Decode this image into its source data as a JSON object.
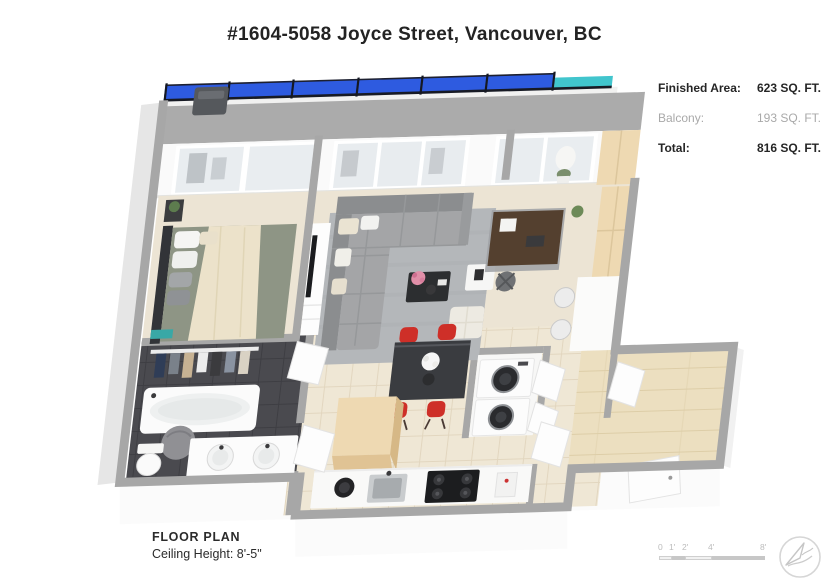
{
  "page": {
    "title": "#1604-5058 Joyce Street, Vancouver, BC"
  },
  "area_summary": {
    "finished": {
      "label": "Finished Area:",
      "value": "623 SQ. FT."
    },
    "balcony": {
      "label": "Balcony:",
      "value": "193 SQ. FT."
    },
    "total": {
      "label": "Total:",
      "value": "816 SQ. FT."
    }
  },
  "footer": {
    "plan_label": "FLOOR PLAN",
    "ceiling_height_label": "Ceiling Height: 8'-5\""
  },
  "scale_bar": {
    "tick_0": "0",
    "tick_1": "1'",
    "tick_2": "2'",
    "tick_4": "4'",
    "tick_8": "8'"
  },
  "colors": {
    "balcony_glass": "#2e5be0",
    "glass_teal": "#41c5cd",
    "chair_red": "#ce2f28",
    "bedding_sage": "#8e9585",
    "cabinet_oak": "#eed9b2",
    "rug_gray": "#b4b7ba",
    "wall_cap": "#a7a7a7",
    "bathroom_tile": "#4a4a4f",
    "floor_tile": "#efe7d5",
    "wood_floor": "#ecdfc0"
  },
  "floorplan": {
    "rooms": [
      "balcony",
      "bedroom",
      "closet",
      "bathroom",
      "living-room",
      "den",
      "dining-area",
      "kitchen",
      "laundry-closet",
      "entry-hall"
    ]
  }
}
